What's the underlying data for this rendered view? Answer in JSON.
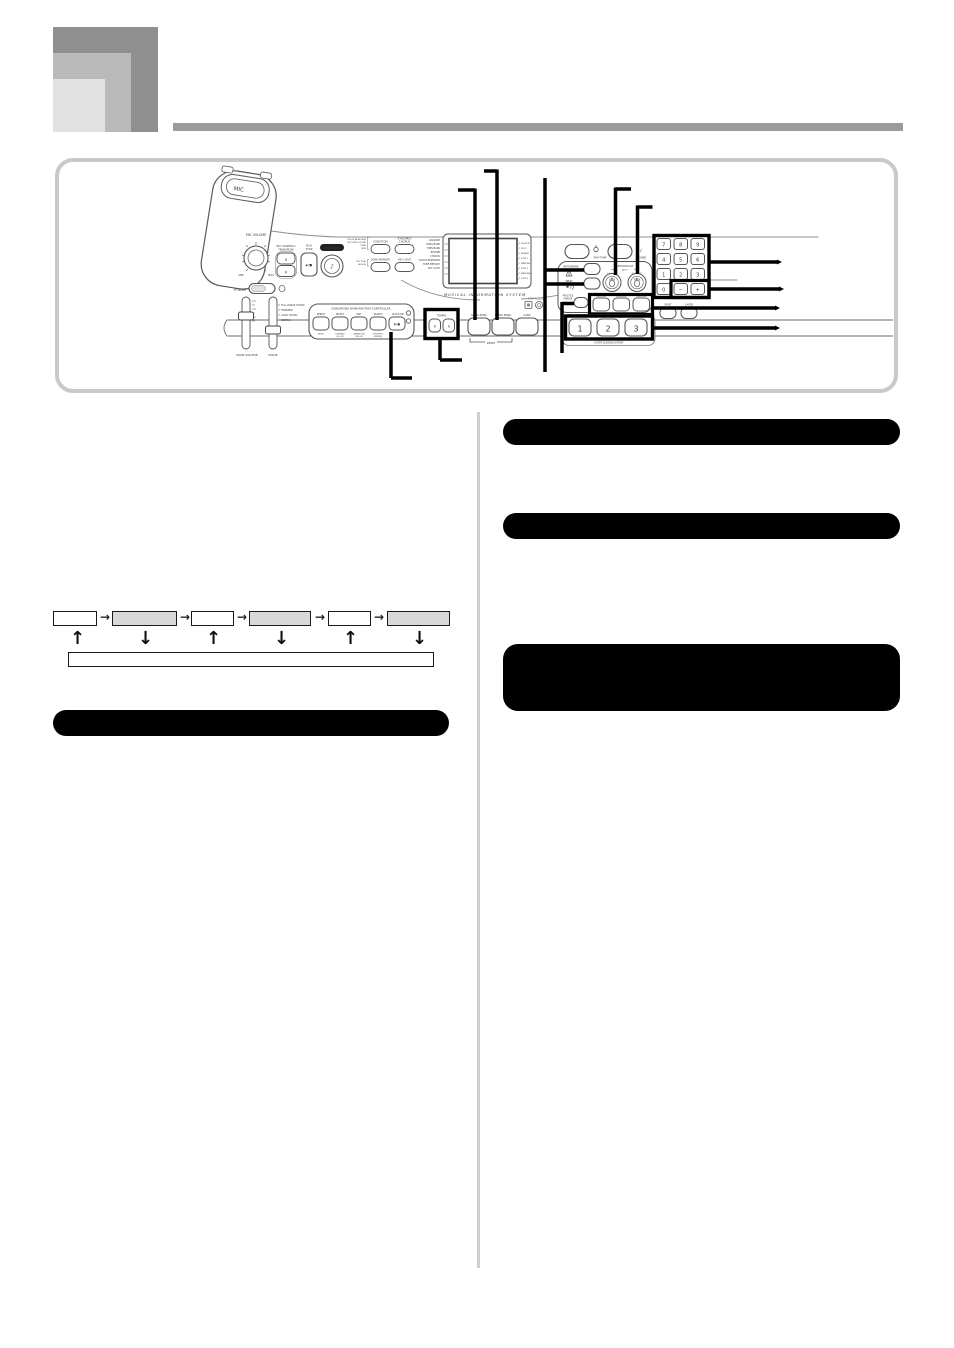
{
  "colors": {
    "rule_gray": "#9b9b9b",
    "square_dark": "#8f8f8f",
    "square_mid": "#b9b9b9",
    "square_light": "#e2e2e2",
    "panel_border": "#c9c9c9",
    "header_black": "#000000",
    "flow_box_gray": "#d8d8d8",
    "divider_gray": "#cfcfcf",
    "line_art": "#4a4a4a"
  },
  "headers": {
    "left_section": "",
    "right_section_1": "",
    "right_section_2": "",
    "right_note_box": ""
  },
  "flowchart": {
    "boxes": [
      "",
      "",
      "",
      "",
      "",
      ""
    ],
    "long_box": "",
    "right_arrow": "→",
    "up_arrow": "↑",
    "down_arrow": "↓"
  },
  "panel": {
    "mic": "MIC",
    "mic_volume": "MIC VOLUME",
    "min": "MIN",
    "max": "MAX",
    "power": "POWER",
    "main_volume": "MAIN VOLUME",
    "mode": "MODE",
    "mode_options": [
      "FULL RANGE CHORD",
      "FINGERED",
      "CASIO CHORD",
      "NORMAL"
    ],
    "key_control": [
      "KEY CONTROL/",
      "TRANSPOSE"
    ],
    "up": "∧",
    "down": "∨",
    "play_stop": [
      "PLAY",
      "STOP"
    ],
    "play_glyph": "▶/■",
    "karaoke": "KARAOKE",
    "karaoke_glyph": "♪",
    "function_block": [
      "TOUCH RESPONSE",
      "ACCOMP VOLUME",
      "TUNE",
      "MIDI"
    ],
    "function": "FUNCTION",
    "synchro": [
      "SYNCHRO/",
      "CHORUS"
    ],
    "mic_block": [
      "MIC PLAY",
      "LESSON"
    ],
    "song_memory": "SONG MEMORY",
    "key_light": "KEY LIGHT",
    "controller": {
      "header": "SONG/PIANO BANK/RHYTHM CONTROLLER",
      "top": [
        "REPEAT",
        "SELECT",
        "EDIT",
        "SEARCH",
        "PLAY/STOP"
      ],
      "bottom": [
        "INTRO",
        "NORMAL/",
        "FILL-IN",
        "VARIATION/",
        "FILL-IN",
        "SYNCHRO/",
        "ENDING"
      ]
    },
    "tempo": "TEMPO",
    "banks": [
      "SONG BANK",
      "PIANO BANK",
      "CARD"
    ],
    "demo": "DEMO",
    "data_access": "DATA ACCESS",
    "display": {
      "left": [
        "KARAOKE",
        "SONG BANK",
        "TWIN BANK",
        "REVERB",
        "CHORUS",
        "TOUCH RESPONSE",
        "TONE MEMORY",
        "KEY LIGHT"
      ],
      "right": [
        "LESSON",
        "SPLIT",
        "REPEAT",
        "STEP 1",
        "WAITING 1",
        "STEP 2",
        "WAITING 2",
        "STEP 3"
      ],
      "caption": "MUSICAL INFORMATION SYSTEM"
    },
    "rhythm": "RHYTHM",
    "tone": "TONE",
    "tone_glyph": "♪",
    "metronome": "METRONOME",
    "lesson_play": "LESSON PLAY",
    "auto": "AUTO",
    "parts": [
      "L (part 1)",
      "R (part 2)"
    ],
    "speak": "SPEAK",
    "practice": [
      "PRACTICE",
      "PHRASE"
    ],
    "lesson_btns": [
      "LESSON 1",
      "LESSON 2",
      "LESSON 3"
    ],
    "steps": [
      "1",
      "2",
      "3"
    ],
    "step_caption": "3-STEP LESSON SYSTEM",
    "keypad": [
      "7",
      "8",
      "9",
      "4",
      "5",
      "6",
      "1",
      "2",
      "3",
      "0",
      "−",
      "+"
    ],
    "split": "SPLIT",
    "layer": "LAYER"
  }
}
